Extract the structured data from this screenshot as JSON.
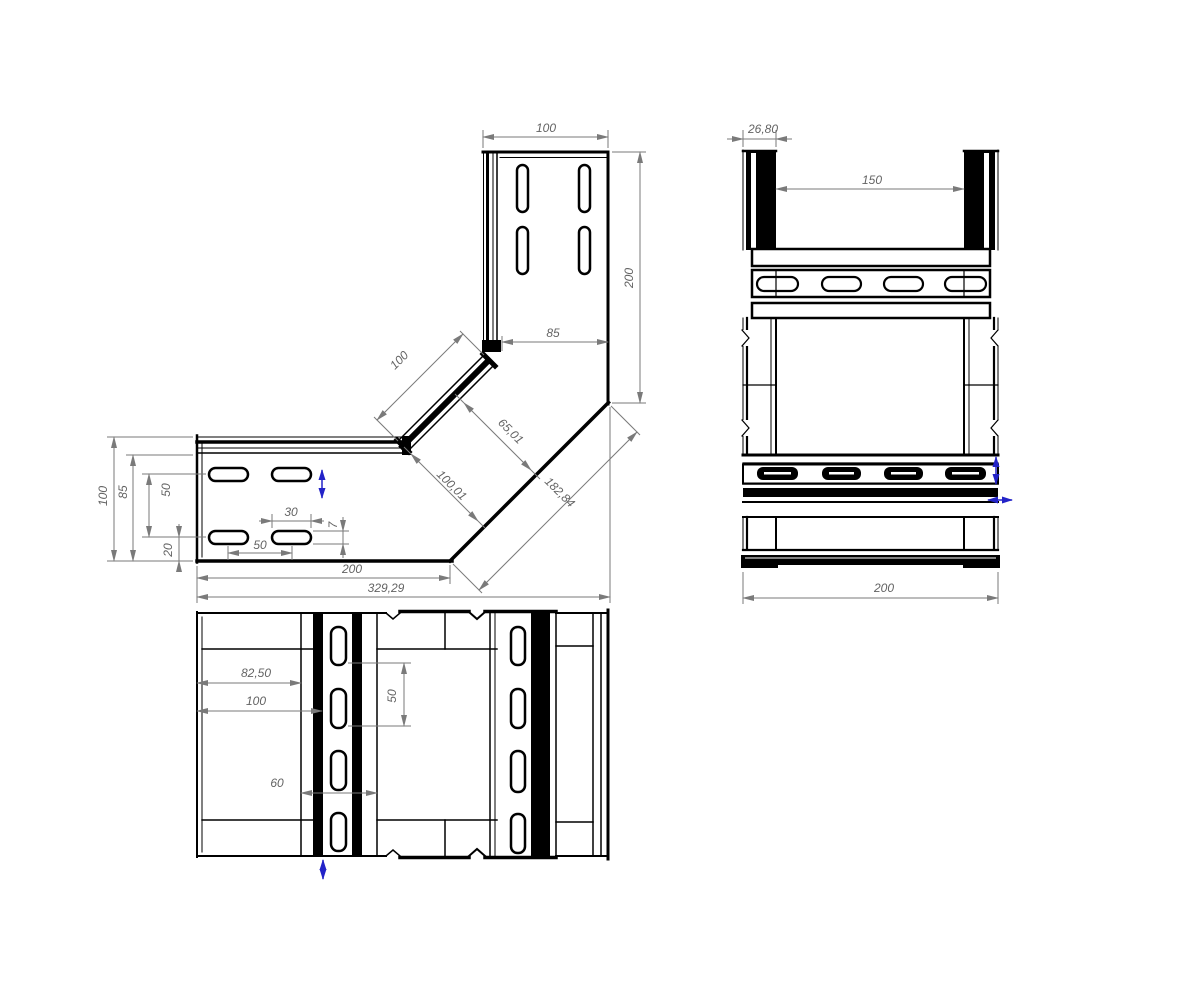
{
  "title": "cable-tray-90-degree-elbow-drawing",
  "colors": {
    "outline": "#000000",
    "dimension_lines": "#7a7a7a",
    "dimension_text": "#636363",
    "direction_arrow": "#2323c8",
    "background": "#ffffff"
  },
  "views": {
    "front": {
      "label": "front-view-elbow",
      "dims": {
        "top_width": "100",
        "right_height": "200",
        "inner_top": "85",
        "diag_outer": "100",
        "diag_width": "65,01",
        "diag_inner": "100,01",
        "diag_total": "182,84",
        "bottom_straight": "200",
        "bottom_total": "329,29",
        "left_outer": "100",
        "left_inner": "85",
        "left_slot_pitch": "50",
        "left_slot_edge": "20",
        "slot_length": "30",
        "slot_width": "7",
        "slot_spacing": "50"
      }
    },
    "side": {
      "label": "side-view",
      "dims": {
        "flange_width": "26,80",
        "inner_span": "150",
        "total_width": "200"
      }
    },
    "top": {
      "label": "top-view",
      "dims": {
        "slot_offset": "82,50",
        "joint_offset": "100",
        "slot_pitch": "50",
        "band_width": "60"
      }
    }
  }
}
